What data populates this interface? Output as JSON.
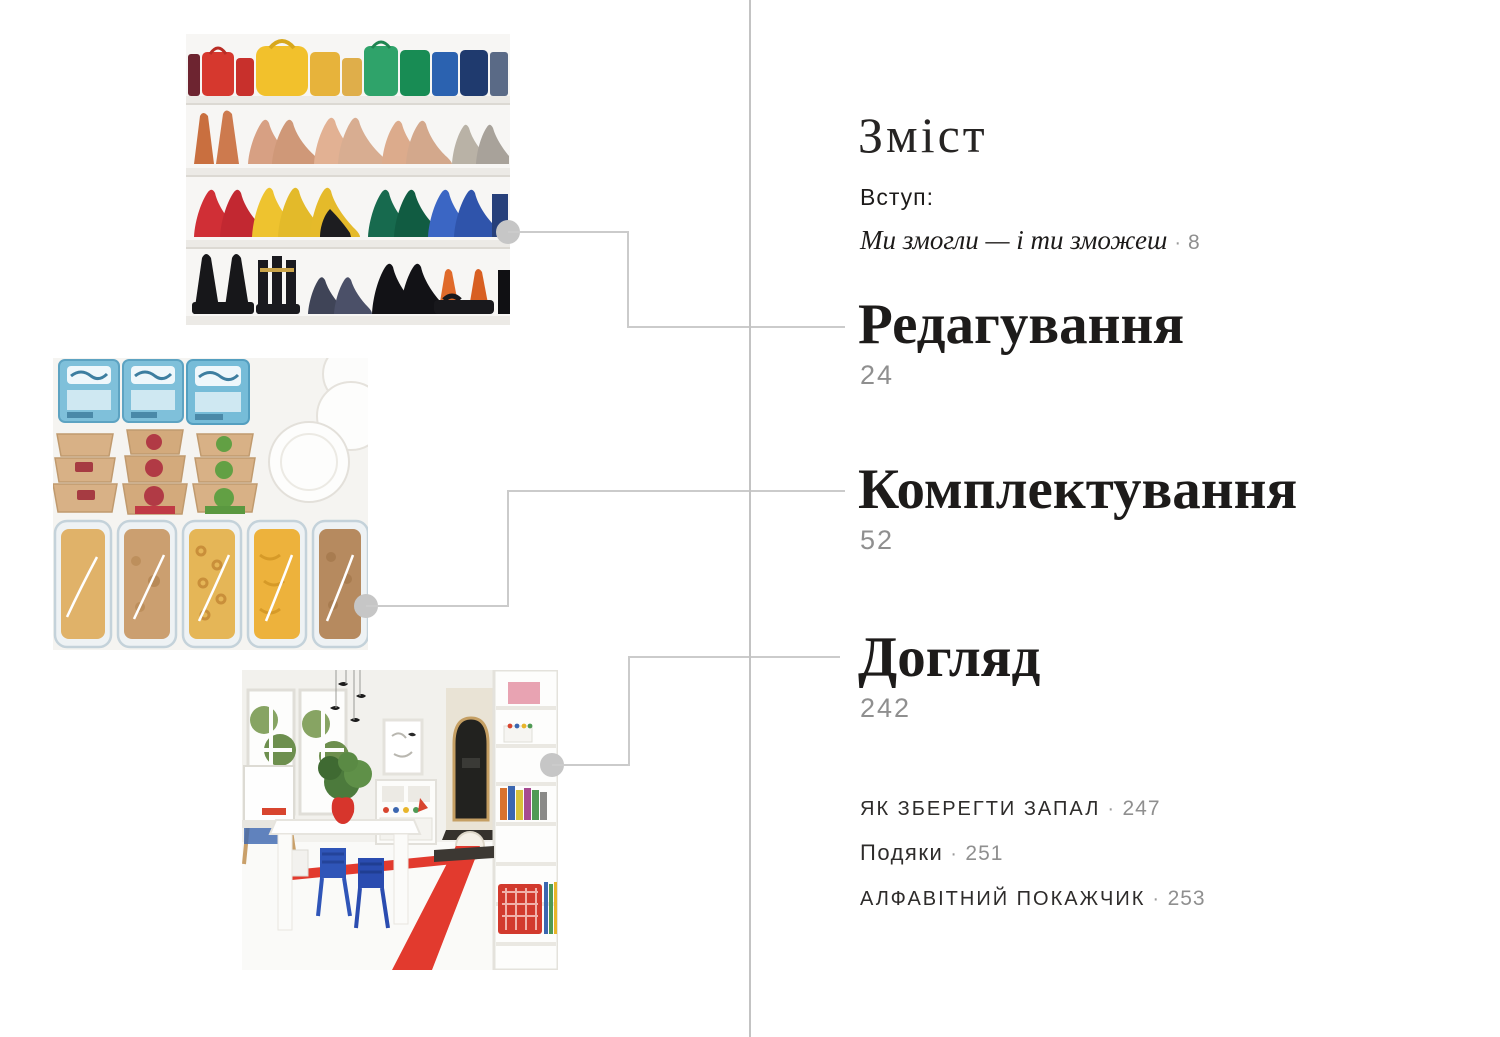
{
  "page": {
    "title": "Зміст"
  },
  "intro": {
    "label": "Вступ:",
    "title_italic": "Ми змогли — і ти зможеш",
    "separator": "·",
    "page": "8"
  },
  "chapters": [
    {
      "title": "Редагування",
      "page": "24"
    },
    {
      "title": "Комплектування",
      "page": "52"
    },
    {
      "title": "Догляд",
      "page": "242"
    }
  ],
  "back_matter": [
    {
      "label": "Як зберегти запал",
      "separator": "·",
      "page": "247"
    },
    {
      "label": "Подяки",
      "separator": "·",
      "page": "251"
    },
    {
      "label": "Алфавітний покажчик",
      "separator": "·",
      "page": "253"
    }
  ],
  "photos": [
    {
      "name": "shoe-closet-photo"
    },
    {
      "name": "pantry-bins-photo"
    },
    {
      "name": "playroom-photo"
    }
  ],
  "colors": {
    "text": "#1d1b1a",
    "page_number_gray": "#8f8f8f",
    "connector_gray": "#cbcbcb",
    "dot_gray": "#c6c6c6",
    "divider_gray": "#c3c3c3"
  }
}
